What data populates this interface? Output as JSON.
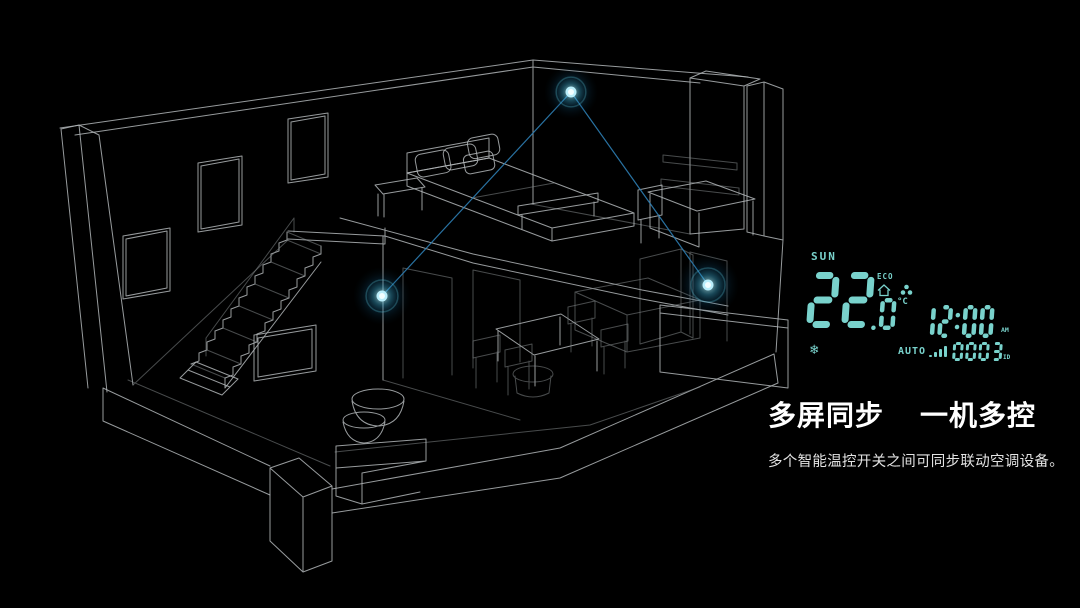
{
  "scene": {
    "heading_left": "多屏同步",
    "heading_right": "一机多控",
    "subtitle": "多个智能温控开关之间可同步联动空调设备。"
  },
  "thermostat": {
    "day": "SUN",
    "temperature_main": "22",
    "temperature_decimal": ".0",
    "temperature_unit": "°C",
    "eco_label": "ECO",
    "time": "12:00",
    "meridiem": "AM",
    "mode_label": "AUTO",
    "channel": "0003",
    "channel_unit": "ID",
    "snowflake_glyph": "❄",
    "icons": [
      "home-icon",
      "purifier-fan-icon",
      "snowflake-icon",
      "signal-bars-icon"
    ]
  },
  "colors": {
    "bg": "#000000",
    "wire": "#b2b6b8",
    "lcd": "#79d2cc",
    "link": "#2e7fb4",
    "glow_core": "#eafdff",
    "glow_mid": "#3aa9cf",
    "glow_outer": "#0b3f5e",
    "heading": "#ffffff",
    "subtitle": "#e3e3e3"
  },
  "devices": [
    {
      "id": "upper",
      "x": 571,
      "y": 92,
      "r": 27
    },
    {
      "id": "left",
      "x": 382,
      "y": 296,
      "r": 29
    },
    {
      "id": "right",
      "x": 708,
      "y": 285,
      "r": 31
    }
  ],
  "links": [
    {
      "from": "upper",
      "to": "left"
    },
    {
      "from": "upper",
      "to": "right"
    }
  ]
}
